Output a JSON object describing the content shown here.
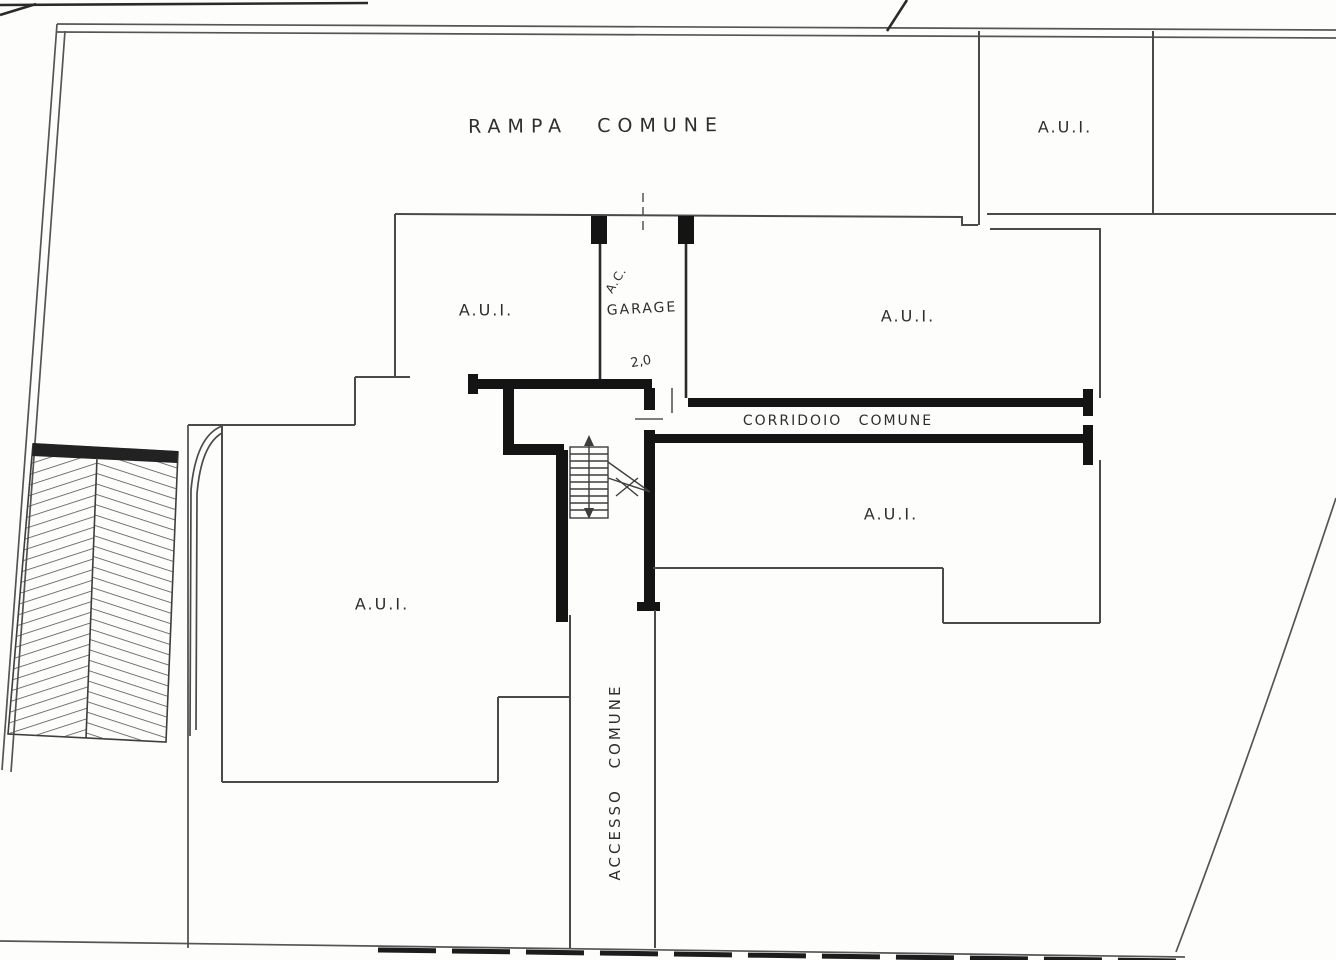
{
  "drawing": {
    "labels": {
      "rampa": "RAMPA COMUNE",
      "corridoio": "CORRIDOIO COMUNE",
      "accesso": "ACCESSO COMUNE",
      "garage": "GARAGE",
      "garage_annotation": "A.C.",
      "garage_dimension": "2,0",
      "unit_top_right": "A.U.I.",
      "unit_upper_left": "A.U.I.",
      "unit_upper_right": "A.U.I.",
      "unit_lower_right": "A.U.I.",
      "unit_lower_left": "A.U.I."
    },
    "colors": {
      "background": "#fdfdfc",
      "thin_line": "#555555",
      "medium_line": "#333333",
      "thick_wall": "#141414",
      "text": "#2e2e2e"
    }
  }
}
